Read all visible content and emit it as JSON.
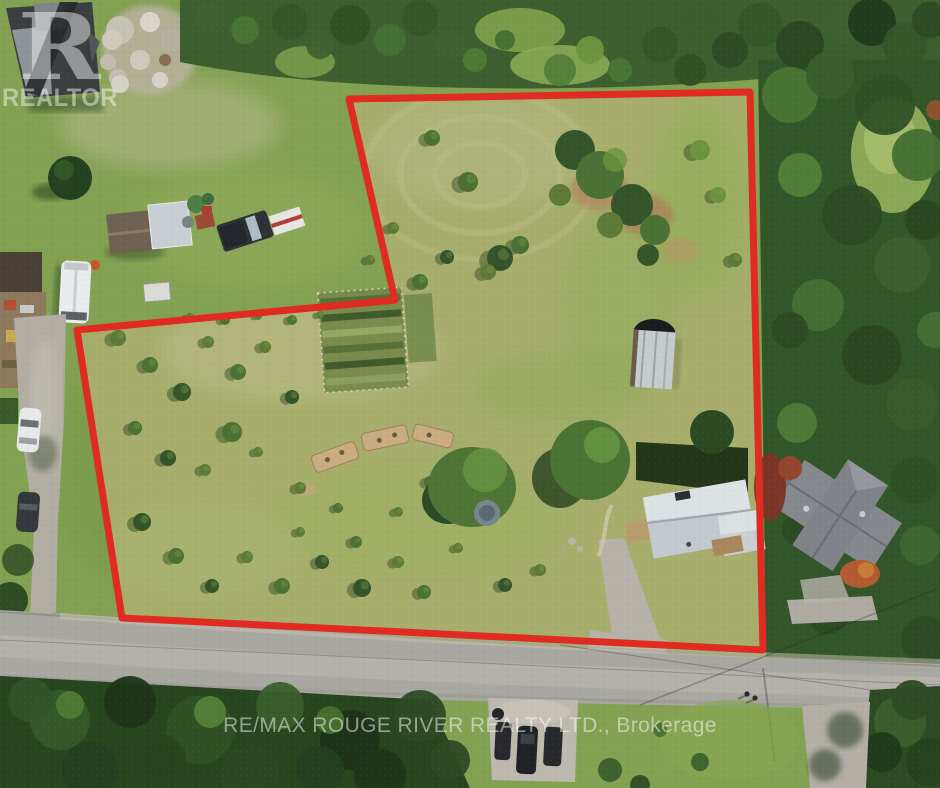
{
  "photo": {
    "description": "Aerial drone view of a rural property with trees, gardens, sheds and houses, outlined by a red property boundary, with a road across the bottom",
    "width_px": 940,
    "height_px": 788
  },
  "watermarks": {
    "realtor": {
      "logo_letter": "R",
      "wordmark": "REALTOR"
    },
    "brokerage": {
      "text": "RE/MAX ROUGE RIVER REALTY LTD., Brokerage"
    }
  },
  "boundary": {
    "points_string": "349,99 750,92 763,650 122,618 77,330 395,300",
    "color": "#df2b22",
    "stroke_width_px": 7
  },
  "palette": {
    "meadow": "#a7ae6c",
    "lawn": "#83a152",
    "tree_dark": "#2c4a24",
    "tree_mid": "#456f33",
    "road_gray": "#a8a7a1",
    "gravel": "#b3afa6",
    "house_roof_light": "#ccd2d6",
    "barn_roof_dark": "#3b3e41",
    "boundary_red": "#df2b22",
    "watermark_white": "rgba(255,255,255,0.45)"
  }
}
